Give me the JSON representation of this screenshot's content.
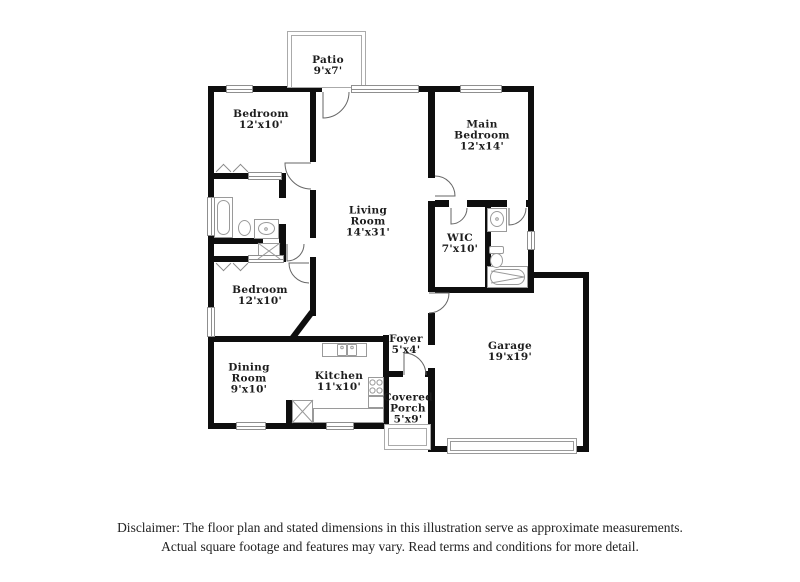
{
  "colors": {
    "wall": "#0e0e0e",
    "fixture_line": "#9a9a9a",
    "window_line": "#8f8f8f",
    "label_text": "#1d1d1d",
    "disclaimer_text": "#222222",
    "background": "#ffffff"
  },
  "rooms": [
    {
      "id": "patio",
      "label": "Patio\n9'x7'"
    },
    {
      "id": "bedroom-1",
      "label": "Bedroom\n12'x10'"
    },
    {
      "id": "main-bedroom",
      "label": "Main\nBedroom\n12'x14'"
    },
    {
      "id": "living-room",
      "label": "Living\nRoom\n14'x31'"
    },
    {
      "id": "wic",
      "label": "WIC\n7'x10'"
    },
    {
      "id": "bedroom-2",
      "label": "Bedroom\n12'x10'"
    },
    {
      "id": "dining-room",
      "label": "Dining\nRoom\n9'x10'"
    },
    {
      "id": "kitchen",
      "label": "Kitchen\n11'x10'"
    },
    {
      "id": "foyer",
      "label": "Foyer\n5'x4'"
    },
    {
      "id": "garage",
      "label": "Garage\n19'x19'"
    },
    {
      "id": "covered-porch",
      "label": "Covered\nPorch\n5'x9'"
    }
  ],
  "disclaimer": {
    "line1": "Disclaimer: The floor plan and stated dimensions in this illustration serve as approximate measurements.",
    "line2": "Actual square footage and features may vary. Read terms and conditions for more detail."
  }
}
